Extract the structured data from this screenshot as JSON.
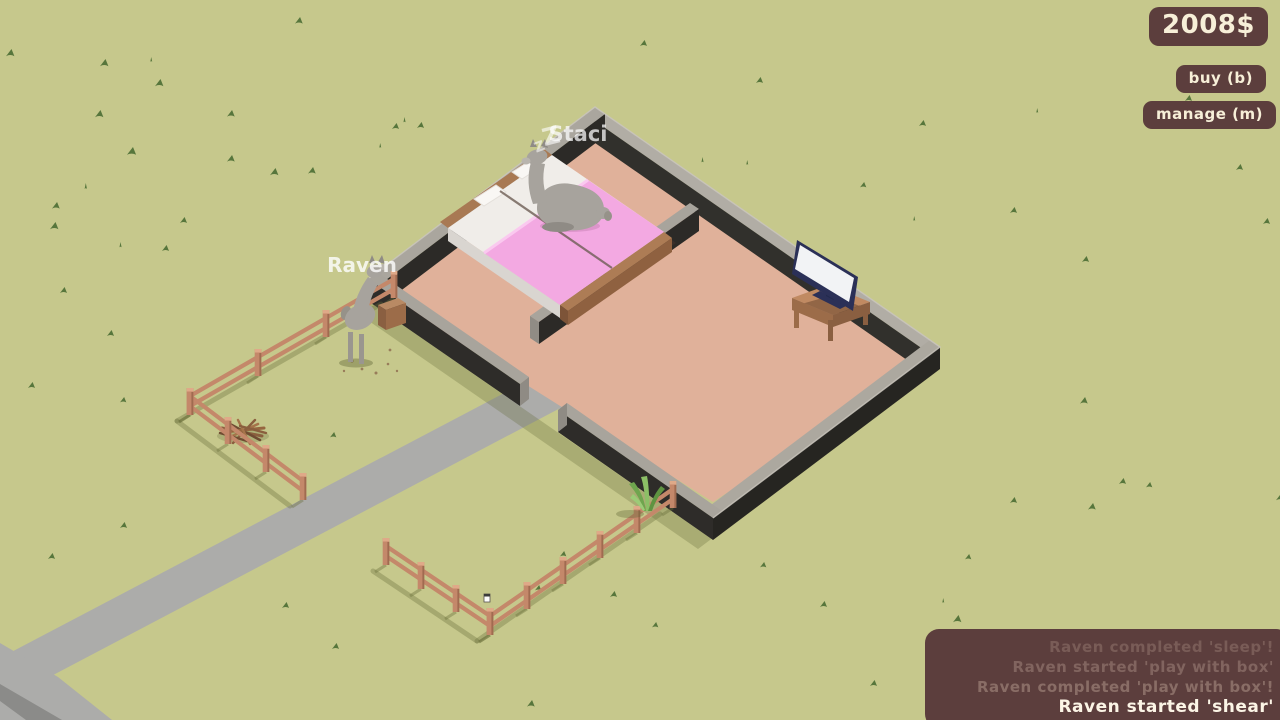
{
  "hud": {
    "money": "2008$",
    "buy_label": "buy (b)",
    "manage_label": "manage (m)"
  },
  "log": {
    "entries": [
      {
        "text": "Raven completed 'sleep'!",
        "state": "faded"
      },
      {
        "text": "Raven started 'play with box'",
        "state": "faded"
      },
      {
        "text": "Raven completed 'play with box'!",
        "state": "faded"
      },
      {
        "text": "Raven started 'shear'",
        "state": "recent"
      }
    ]
  },
  "animals": [
    {
      "name": "Staci",
      "status": "sleeping",
      "sleep_glyph": "Z"
    },
    {
      "name": "Raven",
      "status": "active"
    }
  ],
  "colors": {
    "grass": "#c6c88c",
    "grass_tuft": "#57763c",
    "road": "#acacaa",
    "road_dark": "#8b8b89",
    "wall_top": "#b1ada5",
    "wall_dark": "#2c2a27",
    "floor": "#e0b19a",
    "fence": "#c4886a",
    "bed_pink": "#f3a9e2",
    "bed_white": "#f0ede9",
    "wood": "#a87953",
    "tv_navy": "#2b3057",
    "tv_screen": "#f2f3f5",
    "alpaca": "#a7a39d",
    "panel": "#5c3e3d",
    "panel_text": "#f7efd8",
    "label": "#ffffff"
  }
}
